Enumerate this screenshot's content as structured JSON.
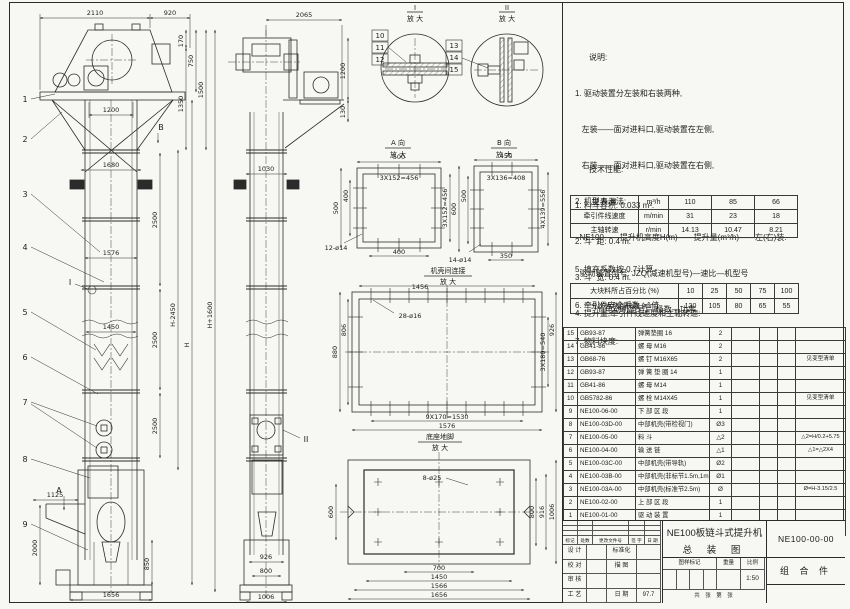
{
  "meta": {
    "sheet_bg": "#f7f7f3",
    "line_color": "#2b2b2b"
  },
  "notes": {
    "title": "说明:",
    "lines": [
      "1. 驱动装置分左装和右装两种,",
      "   左装——面对进料口,驱动装置在左侧,",
      "   右装——面对进料口,驱动装置在右侧,",
      "2. 机型表示法:",
      "  NE100——提升机高度H(m)——提升量(m³/h)——左(右)装.",
      "  驱动装置型号: JZQ(减速机型号)—速比—机型号",
      "          Y(电动机型号)—极数—功率"
    ]
  },
  "tech": {
    "title": "技术性能:",
    "lines": [
      "1. 料斗容积: 0.033 m³.",
      "2. 斗  距: 0.4 m.",
      "3. 斗  宽: 0.4 m.",
      "4. 提升量,牵引件线速度和主轴转速:"
    ],
    "after": [
      "5. 填充系数按 0.7计算.",
      "6. 牵引件安全系数 >1倍.",
      "7. 物料块度:"
    ]
  },
  "chart_data": {
    "type": "table",
    "title": "提升量,牵引件线速度和主轴转速",
    "rows": [
      {
        "label": "提升量",
        "unit": "m³/h",
        "values": [
          110,
          85,
          66
        ]
      },
      {
        "label": "牵引件线速度",
        "unit": "m/min",
        "values": [
          31,
          23,
          18
        ]
      },
      {
        "label": "主轴转速",
        "unit": "r/min",
        "values": [
          14.13,
          10.47,
          8.21
        ]
      }
    ],
    "lump_table": {
      "percent_of_lumps": [
        10,
        25,
        50,
        75,
        100
      ],
      "allowed_lump_size_mm": [
        130,
        105,
        80,
        65,
        55
      ]
    }
  },
  "spec_table": {
    "rows": [
      {
        "label": "提 升 量",
        "unit": "m³/h",
        "c1": "110",
        "c2": "85",
        "c3": "66"
      },
      {
        "label": "牵引件线速度",
        "unit": "m/min",
        "c1": "31",
        "c2": "23",
        "c3": "18"
      },
      {
        "label": "主轴转速",
        "unit": "r/min",
        "c1": "14.13",
        "c2": "10.47",
        "c3": "8.21"
      }
    ]
  },
  "lump_table": {
    "rows": [
      {
        "label": "大块料所占百分比 (%)",
        "c1": "10",
        "c2": "25",
        "c3": "50",
        "c4": "75",
        "c5": "100"
      },
      {
        "label": "允许大块料块度 (mm)",
        "c1": "130",
        "c2": "105",
        "c3": "80",
        "c4": "65",
        "c5": "55"
      }
    ]
  },
  "parts": {
    "headers": {
      "no": "序号",
      "code": "代  号",
      "name": "名  称",
      "qty": "数量",
      "material": "材  料",
      "unit_w": "单重",
      "total_w": "总重",
      "remark": "备 注"
    },
    "rows": [
      {
        "no": "15",
        "code": "GB93-87",
        "name": "弹簧垫圈  16",
        "qty": "2",
        "material": "",
        "unit_w": "",
        "total_w": "",
        "remark": ""
      },
      {
        "no": "14",
        "code": "GB41-86",
        "name": "螺 母  M16",
        "qty": "2",
        "material": "",
        "unit_w": "",
        "total_w": "",
        "remark": ""
      },
      {
        "no": "13",
        "code": "GB68-76",
        "name": "螺 钉  M16X65",
        "qty": "2",
        "material": "",
        "unit_w": "",
        "total_w": "",
        "remark": "见变型清单"
      },
      {
        "no": "12",
        "code": "GB93-87",
        "name": "弹 簧 垫 圈  14",
        "qty": "1",
        "material": "",
        "unit_w": "",
        "total_w": "",
        "remark": ""
      },
      {
        "no": "11",
        "code": "GB41-86",
        "name": "螺 母  M14",
        "qty": "1",
        "material": "",
        "unit_w": "",
        "total_w": "",
        "remark": ""
      },
      {
        "no": "10",
        "code": "GB5782-86",
        "name": "螺 栓  M14X45",
        "qty": "1",
        "material": "",
        "unit_w": "",
        "total_w": "",
        "remark": "见变型清单"
      },
      {
        "no": "9",
        "code": "NE100-06-00",
        "name": "下 部 区 段",
        "qty": "1",
        "material": "",
        "unit_w": "",
        "total_w": "",
        "remark": ""
      },
      {
        "no": "8",
        "code": "NE100-03D-00",
        "name": "中部机壳(带检视门)",
        "qty": "Ø3",
        "material": "",
        "unit_w": "",
        "total_w": "",
        "remark": ""
      },
      {
        "no": "7",
        "code": "NE100-05-00",
        "name": "料 斗",
        "qty": "△2",
        "material": "",
        "unit_w": "",
        "total_w": "",
        "remark": "△2=H/0.2+5.75"
      },
      {
        "no": "6",
        "code": "NE100-04-00",
        "name": "输 送 链",
        "qty": "△1",
        "material": "",
        "unit_w": "",
        "total_w": "",
        "remark": "△1=△2X4"
      },
      {
        "no": "5",
        "code": "NE100-03C-00",
        "name": "中部机壳(带导轨)",
        "qty": "Ø2",
        "material": "",
        "unit_w": "",
        "total_w": "",
        "remark": ""
      },
      {
        "no": "4",
        "code": "NE100-03B-00",
        "name": "中部机壳(非标节1.5m,1m)",
        "qty": "Ø1",
        "material": "",
        "unit_w": "",
        "total_w": "",
        "remark": ""
      },
      {
        "no": "3",
        "code": "NE100-03A-00",
        "name": "中部机壳(标准节2.5m)",
        "qty": "Ø",
        "material": "",
        "unit_w": "",
        "total_w": "",
        "remark": "Ø=H-3.15/2.5"
      },
      {
        "no": "2",
        "code": "NE100-02-00",
        "name": "上 部 区 段",
        "qty": "1",
        "material": "",
        "unit_w": "",
        "total_w": "",
        "remark": ""
      },
      {
        "no": "1",
        "code": "NE100-01-00",
        "name": "驱 动 装 置",
        "qty": "1",
        "material": "",
        "unit_w": "",
        "total_w": "",
        "remark": ""
      }
    ]
  },
  "title_block": {
    "product": "NE100板链斗式提升机",
    "sheet_name": "总 装 图",
    "drawing_no": "NE100-00-00",
    "part_type": "组 合 件",
    "rev_headers": [
      "标记",
      "处数",
      "更改文件号",
      "签 字",
      "日 期"
    ],
    "role1": "设 计",
    "role2": "校 对",
    "role3": "审 核",
    "role4": "工 艺",
    "aux1": "标准化",
    "aux2": "描 图",
    "aux3": "",
    "aux4": "日 期",
    "date": "97.7",
    "mark_label": "图样标记",
    "weight_label": "重量",
    "scale_label": "比例",
    "scale": "1:50",
    "sheets_label": "共  张  第  张"
  },
  "titles": {
    "i": "I",
    "ii": "II",
    "enlarge": "放 大",
    "va": "A 向",
    "vb": "B 向",
    "conn": "机壳间连接",
    "base": "底座地脚"
  },
  "markers": {
    "a": "A",
    "b": "B",
    "i": "I",
    "ii": "II"
  },
  "balloons": {
    "b1": "1",
    "b2": "2",
    "b3": "3",
    "b4": "4",
    "b5": "5",
    "b6": "6",
    "b7": "7",
    "b8": "8",
    "b9": "9",
    "b10": "10",
    "b11": "11",
    "b12": "12",
    "b13": "13",
    "b14": "14",
    "b15": "15"
  },
  "d": {
    "v1_2110": "2110",
    "v1_920": "920",
    "v1_170": "170",
    "v1_750": "750",
    "v1_1350": "1350",
    "v1_1500": "1500",
    "v1_1200": "1200",
    "v1_1680": "1680",
    "v1_2500a": "2500",
    "v1_1576": "1576",
    "v1_1450": "1450",
    "v1_2500b": "2500",
    "v1_2500c": "2500",
    "v1_H2450": "H-2450",
    "v1_H": "H",
    "v1_H1600": "H+1600",
    "v1_1125": "1125",
    "v1_2000": "2000",
    "v1_850": "850",
    "v1_1656": "1656",
    "v2_2065": "2065",
    "v2_1200": "1200",
    "v2_130": "130",
    "v2_1030": "1030",
    "v2_926": "926",
    "v2_800": "800",
    "v2_1006": "1006",
    "a_500t": "500",
    "a_456t": "3X152=456",
    "a_500l": "500",
    "a_400l": "400",
    "a_400b": "400",
    "a_456r": "3X152=456",
    "a_holes": "12-ø14",
    "vb_450": "450",
    "vb_408": "3X136=408",
    "vb_600": "600",
    "vb_500": "500",
    "vb_350": "350",
    "vb_556": "4X139=556",
    "vb_holes": "14-ø14",
    "c_1456": "1456",
    "c_holes": "28-ø16",
    "c_880": "880",
    "c_806": "806",
    "c_540": "3X180=540",
    "c_926": "926",
    "c_1530": "9X170=1530",
    "c_1576": "1576",
    "dd_holes": "8-ø25",
    "dd_600": "600",
    "dd_800": "800",
    "dd_916": "916",
    "dd_1006": "1006",
    "dd_700": "700",
    "dd_1450": "1450",
    "dd_1566": "1566",
    "dd_1656": "1656"
  }
}
